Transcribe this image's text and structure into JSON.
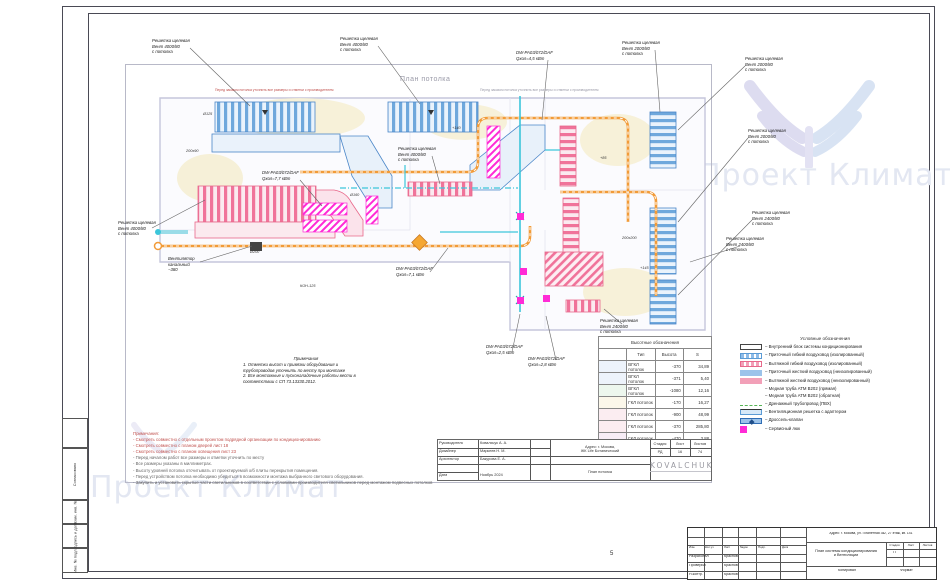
{
  "watermark": {
    "text": "Проект Климат"
  },
  "plan": {
    "title": "План потолка",
    "strip_note_red": "Перед заказом потолка уточнить все размеры и отметки с производителем",
    "strip_note_gray": "Перед заказом потолка уточнить все размеры и отметки с производителем",
    "callouts": [
      {
        "text": "Решетка щелевая\nВент 4000/80\nс потолка"
      },
      {
        "text": "Решетка щелевая\nВент 4000/80\nс потолка"
      },
      {
        "text": "DW-PA03/072/DAF\nQхол=4,5 кВт"
      },
      {
        "text": "Решетка щелевая\nВент 2000/80\nс потолка"
      },
      {
        "text": "Решетка щелевая\nВент 2000/80\nс потолка"
      },
      {
        "text": "Решетка щелевая\nВент 2000/80\nс потолка"
      },
      {
        "text": "Решетка щелевая\nВент 2400/80\nс потолка"
      },
      {
        "text": "Решетка щелевая\nВент 2400/80\nс потолка"
      },
      {
        "text": "Решетка щелевая\nВент 4000/80\nс потолка"
      },
      {
        "text": "Вентилятор\nканальный\n−380"
      },
      {
        "text": "DW-PA03/072/DAF\nQхол=7,7 кВт"
      },
      {
        "text": "Решетка щелевая\nВент 4000/80\nс потолка"
      },
      {
        "text": "DW-PA03/072/DAF\nQхол=7,1 кВт"
      },
      {
        "text": "DW-PA03/072/DAF\nQхол=2,5 кВт"
      },
      {
        "text": "DW-PA03/072/DAF\nQхол=2,8 кВт"
      },
      {
        "text": "Решетка щелевая\nВент 2400/80\nс потолка"
      }
    ],
    "dims": [
      "Ø125",
      "200x90",
      "Ø200",
      "+140",
      "+85",
      "+145",
      "200x200",
      "КОН-125",
      "Ø160"
    ]
  },
  "schedule": {
    "title": "Высотные обозначения",
    "columns": [
      "Тип",
      "Высота",
      "S"
    ],
    "rows": [
      {
        "type": "ВГКЛ потолок",
        "height": "-370",
        "s": "34,89",
        "swatch": "#EDF3FB"
      },
      {
        "type": "ВГКЛ потолок",
        "height": "-371",
        "s": "5,40",
        "swatch": "#EDF3FB"
      },
      {
        "type": "ВГКЛ потолок",
        "height": "-1080",
        "s": "12,16",
        "swatch": "#EDF7EE"
      },
      {
        "type": "ГКЛ потолок",
        "height": "-170",
        "s": "16,27",
        "swatch": "#FBF7EA"
      },
      {
        "type": "ГКЛ потолок",
        "height": "-900",
        "s": "48,99",
        "swatch": "#FBEDF1"
      },
      {
        "type": "ГКЛ потолок",
        "height": "-370",
        "s": "285,80",
        "swatch": "#FBEDF1"
      },
      {
        "type": "ГКЛ потолок",
        "height": "-470",
        "s": "3,88",
        "swatch": "#F7EDF6"
      }
    ]
  },
  "legend": {
    "title": "Условные обозначения",
    "items": [
      {
        "symbol": "indoor-unit",
        "label": "–  Внутренний блок системы кондиционирования"
      },
      {
        "symbol": "supply-flex-duct",
        "label": "–  Приточный гибкий воздуховод (изолированный)"
      },
      {
        "symbol": "exhaust-flex-duct",
        "label": "–  Вытяжной гибкий воздуховод (изолированный)"
      },
      {
        "symbol": "supply-rigid-duct",
        "label": "–  Приточный жесткий воздуховод (неизолированный)"
      },
      {
        "symbol": "exhaust-rigid-duct",
        "label": "–  Вытяжной жесткий воздуховод (неизолированный)"
      },
      {
        "symbol": "none",
        "label": "– Медная труба АТМ В202 (прямая)"
      },
      {
        "symbol": "none",
        "label": "– Медная труба АТМ В202 (обратная)"
      },
      {
        "symbol": "drain-pipe",
        "label": "–  Дренажный трубопровод (ПВХ)"
      },
      {
        "symbol": "grille-adapter",
        "label": "–  Вентиляционная решетка с адаптером"
      },
      {
        "symbol": "damper",
        "label": "–  Дроссель-клапан"
      },
      {
        "symbol": "service-hatch",
        "label": "–  Сервисный люк"
      }
    ]
  },
  "notes_black": {
    "title": "Примечания",
    "body": "1. Отметки высот и привязки оборудования и\nтрубопроводов уточнить по месту при монтаже\n2. Все монтажные и пусконаладочные работы вести в\nсоответствии с СП 73.13330.2012."
  },
  "notes_red": {
    "title": "Примечания:",
    "red_lines": [
      "- Смотреть совместно с отдельным проектом подрядной организации по кондиционированию",
      "- Смотреть совместно с планом дверей лист 18",
      "- Смотреть совместно с планом освещения лист 23"
    ],
    "gray_lines": [
      "- Перед началом работ все размеры и отметки уточнить по месту",
      "- Все размеры указаны в миллиметрах.",
      "- Высоту уровней потолка отсчитывать от проектируемой о/б плиты перекрытия помещения.",
      "- Перед устройством потолка необходимо убедиться в возможности монтажа выбранного светового оборудования.",
      "- Закупить и установить скрытые части светильников в соответствии с условиями производителя светильников перед монтажом подвесных потолков"
    ]
  },
  "inner_stamp": {
    "rows": [
      {
        "label": "Руководитель",
        "value": "Ковальчук А. А."
      },
      {
        "label": "Дизайнер",
        "value": "Маркеев Н. М."
      },
      {
        "label": "Архитектор",
        "value": "Бакурова Е. А."
      },
      {
        "label": "Дата",
        "value": "Ноябрь 2024"
      }
    ],
    "address": "Адрес: г. Москва,\nЖК Life Ботанический",
    "doc_title": "План потолка",
    "stage_label": "Стадия",
    "sheet_label": "Лист",
    "sheets_label": "Листов",
    "stage": "РД",
    "sheet": "16",
    "sheets": "74",
    "logo": "KOVALCHUK"
  },
  "main_stamp": {
    "cols": [
      "Изм.",
      "Кол.уч",
      "Лист",
      "№док.",
      "Подп.",
      "Дата"
    ],
    "rows": [
      {
        "label": "Разработал",
        "value": "Краснов"
      },
      {
        "label": "Проверил",
        "value": "Краснов"
      },
      {
        "label": "Н.контр.",
        "value": "Краснов"
      }
    ],
    "address": "Адрес: г. Москва, ул. Планетная 3к2, 27 этаж, кв. 141",
    "doc_title": "План системы кондиционирования\nи Вентиляции",
    "stage_label": "Стадия",
    "sheet_label": "Лист",
    "sheets_label": "Листов",
    "stage": "П",
    "copy_label": "Копировал",
    "format_label": "Формат"
  },
  "side_labels": {
    "agreed": "Согласовано",
    "replace": "Взам. инв. №",
    "sign_date": "Подпись и дата",
    "inv": "Инв. № подл."
  },
  "page_number": "5",
  "colors": {
    "supply_duct": "#6FA8DC",
    "exhaust_duct": "#F0739A",
    "flex_round_duct": "#F29B38",
    "refrigerant_line": "#3CC6DA",
    "service_hatch": "#FF2BD6",
    "drain": "#55B455",
    "note_red": "#C0504D",
    "watermark": "#E3E7F2"
  }
}
